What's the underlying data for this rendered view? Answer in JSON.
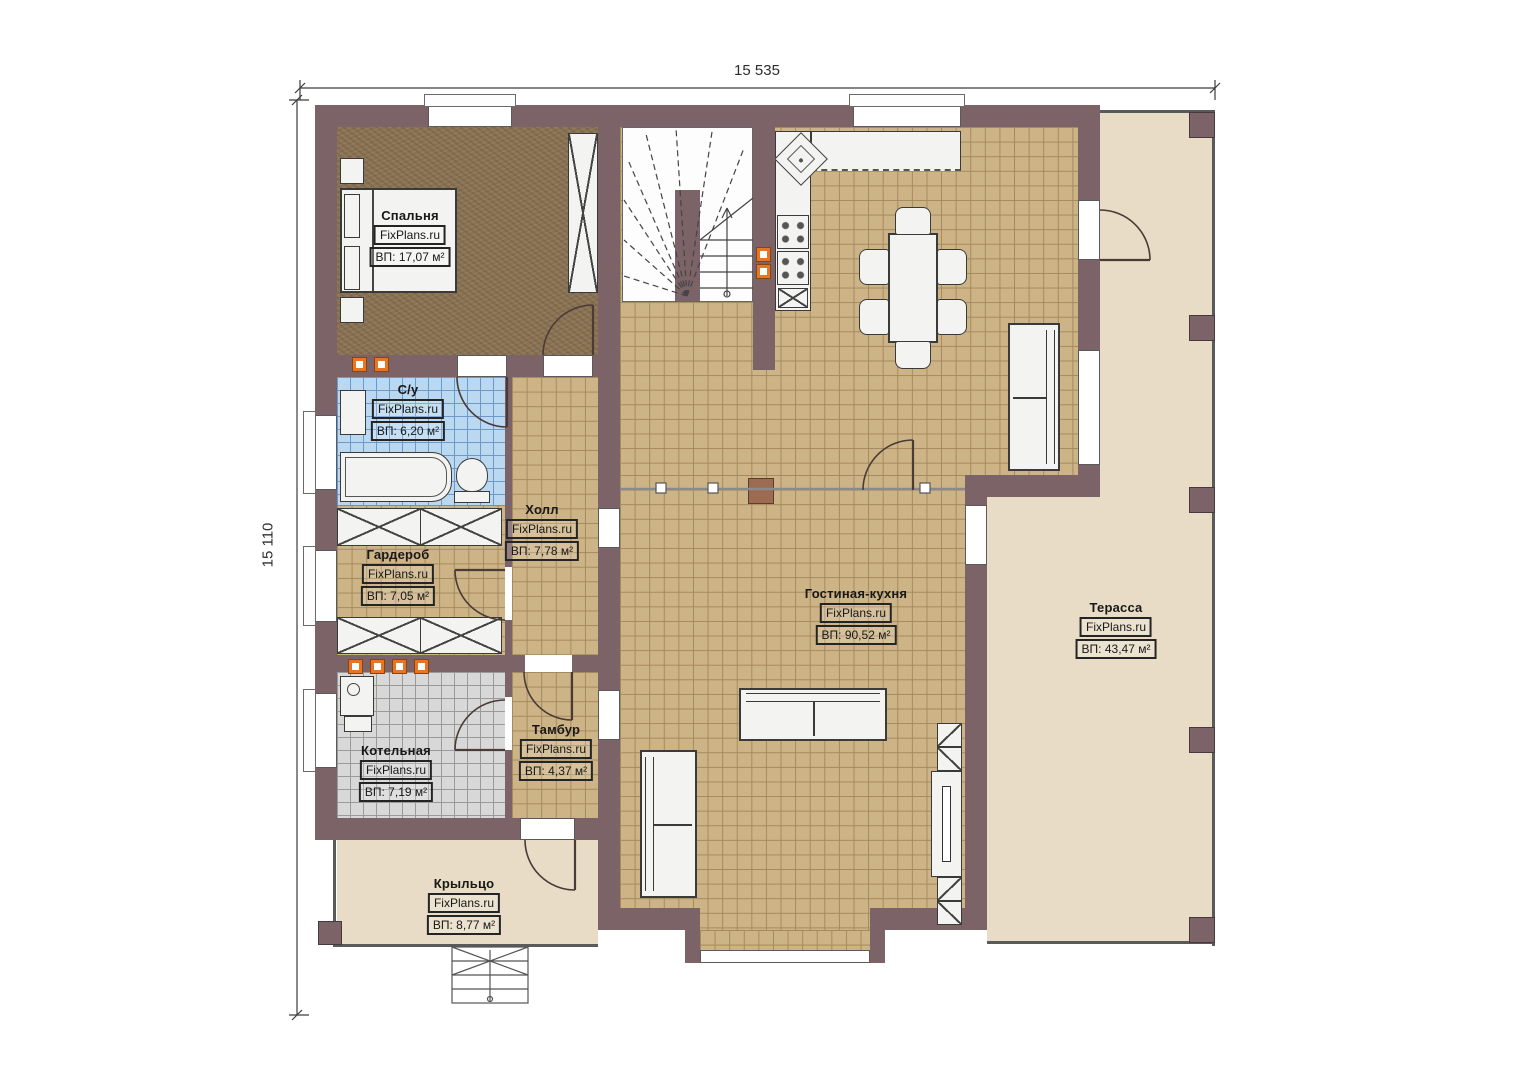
{
  "watermark": "FixPlans.ru",
  "dimensions": {
    "top": "15 535",
    "left": "15 110"
  },
  "rooms": [
    {
      "id": "bedroom",
      "name": "Спальня",
      "area": "ВП: 17,07 м²"
    },
    {
      "id": "bathroom",
      "name": "С/у",
      "area": "ВП: 6,20 м²"
    },
    {
      "id": "hall",
      "name": "Холл",
      "area": "ВП: 7,78 м²"
    },
    {
      "id": "wardrobe",
      "name": "Гардероб",
      "area": "ВП: 7,05 м²"
    },
    {
      "id": "boiler-room",
      "name": "Котельная",
      "area": "ВП: 7,19 м²"
    },
    {
      "id": "vestibule",
      "name": "Тамбур",
      "area": "ВП: 4,37 м²"
    },
    {
      "id": "living-kitchen",
      "name": "Гостиная-кухня",
      "area": "ВП: 90,52 м²"
    },
    {
      "id": "terrace",
      "name": "Терасса",
      "area": "ВП: 43,47 м²"
    },
    {
      "id": "porch",
      "name": "Крыльцо",
      "area": "ВП: 8,77 м²"
    }
  ],
  "colors": {
    "wall": "#7c6367",
    "floor_tile": "#cdb487",
    "bathroom_tile": "#bad8f0",
    "boiler_tile": "#d8d8d8",
    "bedroom_carpet": "#8a7355",
    "outdoor": "#e8dcc6",
    "accent_orange": "#e87425"
  }
}
